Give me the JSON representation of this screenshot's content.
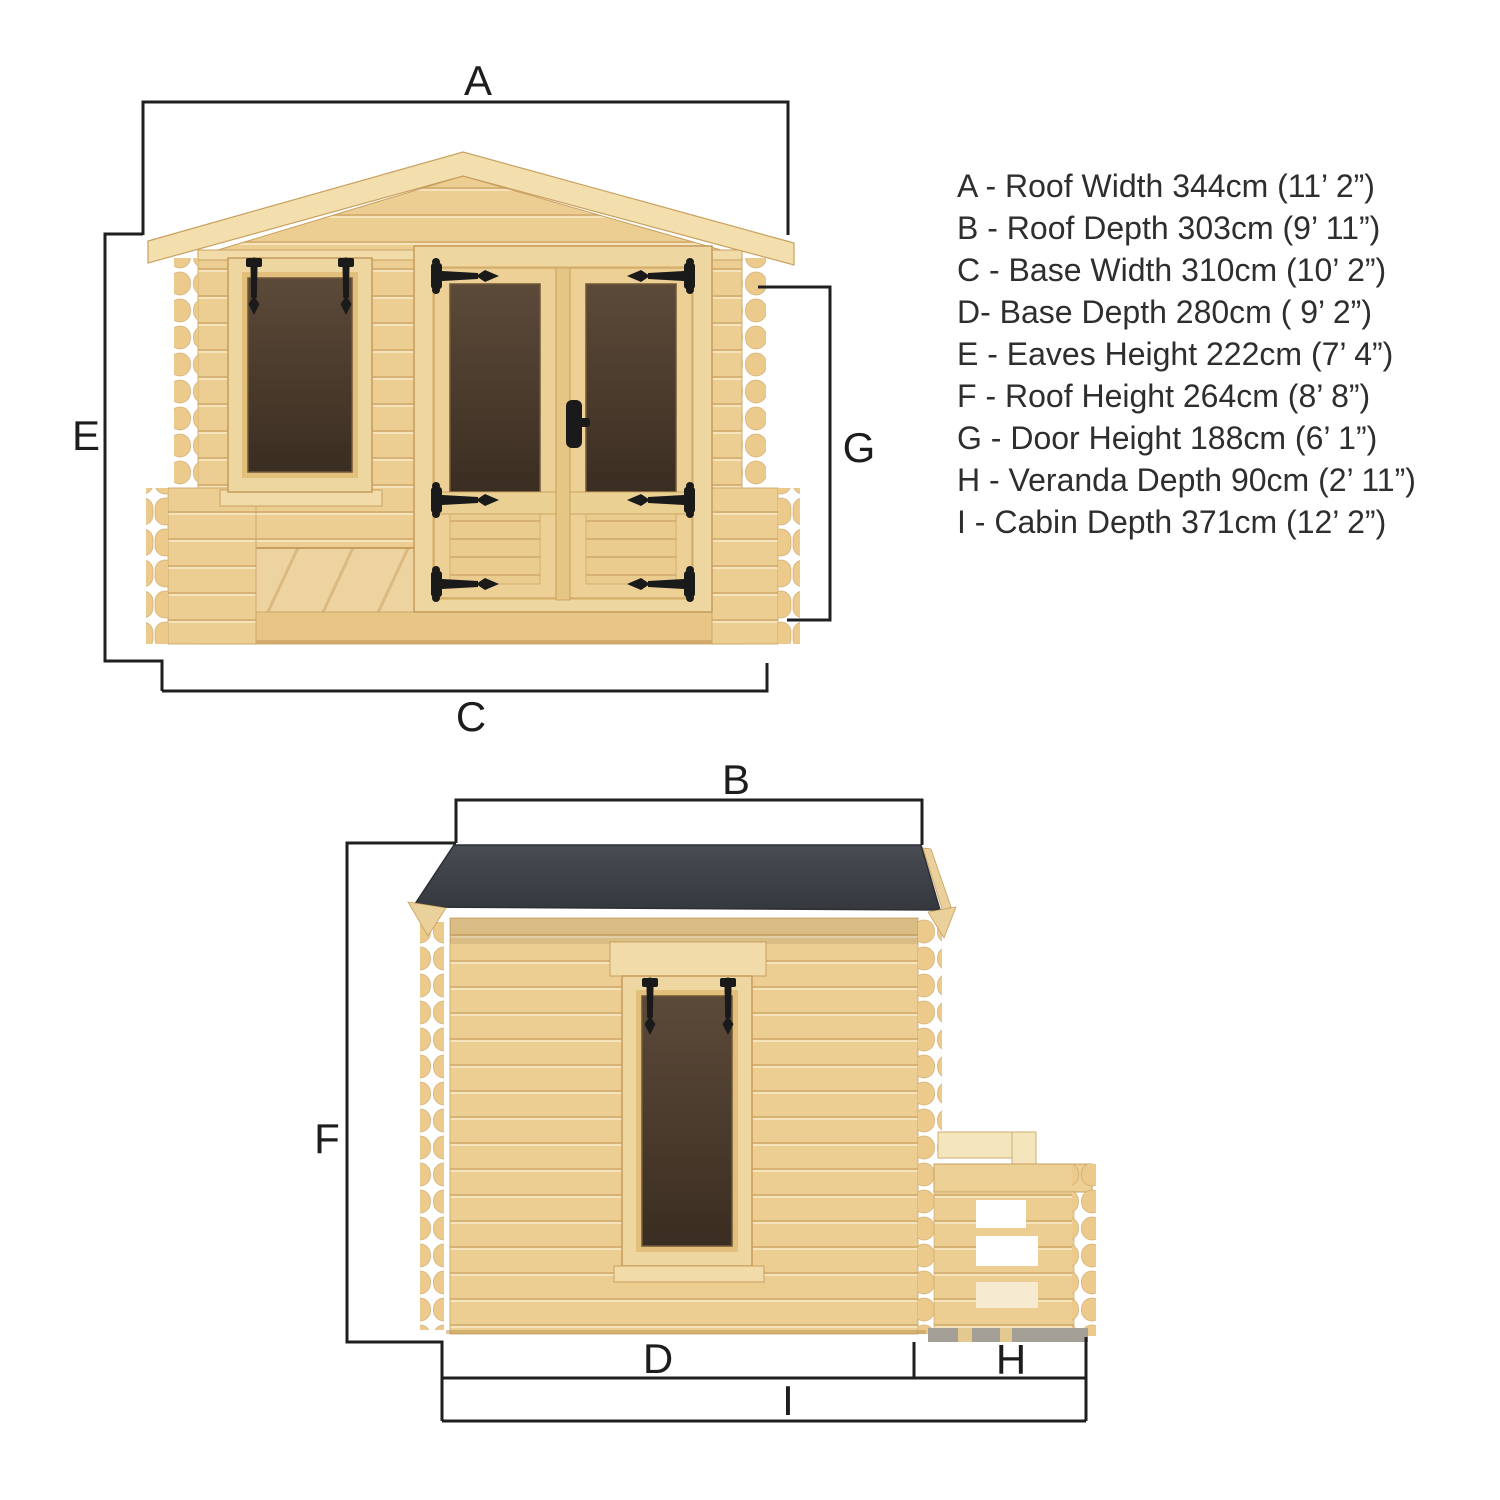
{
  "colors": {
    "background": "#ffffff",
    "wood_base": "#ecce93",
    "wood_light": "#f3dfae",
    "wood_line": "#c49a5c",
    "glass_dark": "#3a2d21",
    "roof_felt": "#3a3e44",
    "hardware_black": "#1a1a1a",
    "dimension_line": "#1f1f1f",
    "legend_text": "#2e2e2e"
  },
  "dimension_labels": {
    "a": "A",
    "b": "B",
    "c": "C",
    "d": "D",
    "e": "E",
    "f": "F",
    "g": "G",
    "h": "H",
    "i": "I"
  },
  "legend": {
    "items": [
      {
        "letter": "A",
        "text": "A - Roof Width 344cm (11’ 2”)"
      },
      {
        "letter": "B",
        "text": "B - Roof Depth 303cm (9’ 11”)"
      },
      {
        "letter": "C",
        "text": "C - Base Width 310cm (10’ 2”)"
      },
      {
        "letter": "D",
        "text": "D- Base Depth 280cm ( 9’ 2”)"
      },
      {
        "letter": "E",
        "text": "E - Eaves Height 222cm (7’ 4”)"
      },
      {
        "letter": "F",
        "text": "F - Roof Height 264cm (8’ 8”)"
      },
      {
        "letter": "G",
        "text": "G - Door Height 188cm (6’ 1”)"
      },
      {
        "letter": "H",
        "text": "H - Veranda Depth 90cm (2’ 11”)"
      },
      {
        "letter": "I",
        "text": "I - Cabin Depth 371cm (12’ 2”)"
      }
    ]
  },
  "measurements": [
    {
      "letter": "A",
      "name": "Roof Width",
      "cm": 344,
      "imperial": "11’ 2”"
    },
    {
      "letter": "B",
      "name": "Roof Depth",
      "cm": 303,
      "imperial": "9’ 11”"
    },
    {
      "letter": "C",
      "name": "Base Width",
      "cm": 310,
      "imperial": "10’ 2”"
    },
    {
      "letter": "D",
      "name": "Base Depth",
      "cm": 280,
      "imperial": "9’ 2”"
    },
    {
      "letter": "E",
      "name": "Eaves Height",
      "cm": 222,
      "imperial": "7’ 4”"
    },
    {
      "letter": "F",
      "name": "Roof Height",
      "cm": 264,
      "imperial": "8’ 8”"
    },
    {
      "letter": "G",
      "name": "Door Height",
      "cm": 188,
      "imperial": "6’ 1”"
    },
    {
      "letter": "H",
      "name": "Veranda Depth",
      "cm": 90,
      "imperial": "2’ 11”"
    },
    {
      "letter": "I",
      "name": "Cabin Depth",
      "cm": 371,
      "imperial": "12’ 2”"
    }
  ]
}
